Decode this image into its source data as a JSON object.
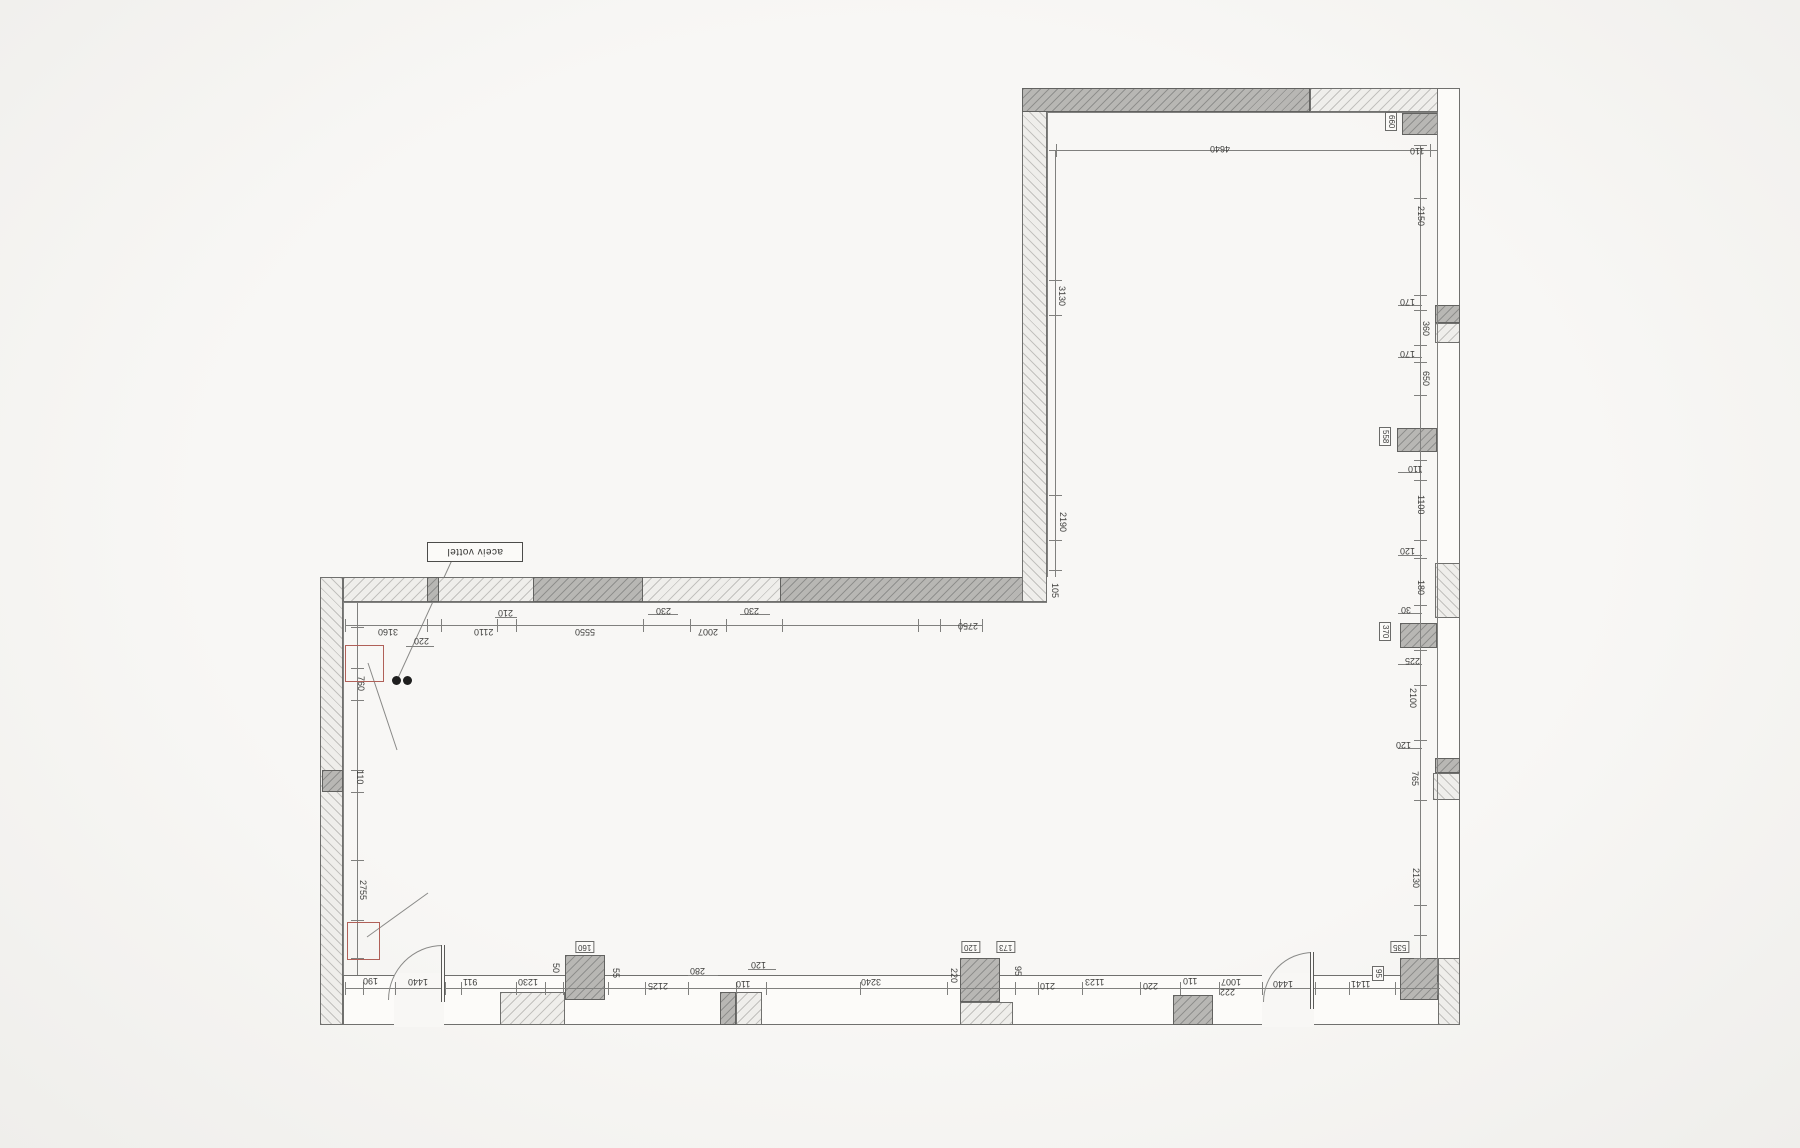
{
  "plan": {
    "label_box": {
      "text": "aceiv vottel"
    },
    "colors": {
      "wall_outline": "#70706e",
      "dark_fill": "#b8b7b4",
      "hatch_fill": "#efeeeb",
      "dimension_text": "#3d3d3b",
      "marker_red": "#b06058",
      "dot_black": "#1f1f1f"
    },
    "walls": [
      {
        "name": "left-wall",
        "x": 320,
        "y": 577,
        "w": 23,
        "h": 448,
        "style": "hatch-v"
      },
      {
        "name": "left-wall-pier",
        "x": 322,
        "y": 770,
        "w": 21,
        "h": 22,
        "style": "dark"
      },
      {
        "name": "lower-top-wall",
        "x": 343,
        "y": 577,
        "w": 704,
        "h": 25,
        "style": "hatch-h"
      },
      {
        "name": "lower-top-wall-pier",
        "x": 427,
        "y": 577,
        "w": 12,
        "h": 25,
        "style": "dark"
      },
      {
        "name": "lower-top-window-a",
        "x": 533,
        "y": 577,
        "w": 110,
        "h": 25,
        "style": "dark"
      },
      {
        "name": "lower-top-window-b",
        "x": 780,
        "y": 577,
        "w": 260,
        "h": 25,
        "style": "dark"
      },
      {
        "name": "upper-left-wall",
        "x": 1022,
        "y": 88,
        "w": 25,
        "h": 514,
        "style": "hatch-v"
      },
      {
        "name": "upper-top-wall-dark",
        "x": 1022,
        "y": 88,
        "w": 288,
        "h": 24,
        "style": "dark"
      },
      {
        "name": "upper-top-wall-light",
        "x": 1310,
        "y": 88,
        "w": 150,
        "h": 24,
        "style": "hatch-h"
      },
      {
        "name": "right-wall",
        "x": 1437,
        "y": 88,
        "w": 23,
        "h": 937,
        "style": "plain"
      },
      {
        "name": "right-pier-1",
        "x": 1402,
        "y": 113,
        "w": 36,
        "h": 22,
        "style": "dark"
      },
      {
        "name": "right-pier-2a",
        "x": 1435,
        "y": 305,
        "w": 25,
        "h": 18,
        "style": "dark"
      },
      {
        "name": "right-pier-2b",
        "x": 1435,
        "y": 323,
        "w": 25,
        "h": 20,
        "style": "hatch-h"
      },
      {
        "name": "right-pier-3",
        "x": 1397,
        "y": 428,
        "w": 40,
        "h": 24,
        "style": "dark"
      },
      {
        "name": "right-pilaster",
        "x": 1435,
        "y": 563,
        "w": 25,
        "h": 55,
        "style": "hatch-v"
      },
      {
        "name": "right-pier-4",
        "x": 1400,
        "y": 623,
        "w": 37,
        "h": 25,
        "style": "dark"
      },
      {
        "name": "right-pier-5a",
        "x": 1435,
        "y": 758,
        "w": 25,
        "h": 15,
        "style": "dark"
      },
      {
        "name": "right-pier-5b",
        "x": 1433,
        "y": 773,
        "w": 27,
        "h": 27,
        "style": "hatch-v"
      },
      {
        "name": "bottom-wall",
        "x": 343,
        "y": 975,
        "w": 1117,
        "h": 50,
        "style": "plain"
      },
      {
        "name": "bottom-hatch-1",
        "x": 500,
        "y": 992,
        "w": 65,
        "h": 33,
        "style": "hatch-h"
      },
      {
        "name": "bottom-pier-1",
        "x": 565,
        "y": 955,
        "w": 40,
        "h": 45,
        "style": "dark"
      },
      {
        "name": "bottom-pier-2",
        "x": 720,
        "y": 992,
        "w": 16,
        "h": 33,
        "style": "dark"
      },
      {
        "name": "bottom-hatch-2",
        "x": 736,
        "y": 992,
        "w": 26,
        "h": 33,
        "style": "hatch-h"
      },
      {
        "name": "bottom-pier-3",
        "x": 960,
        "y": 958,
        "w": 40,
        "h": 44,
        "style": "dark"
      },
      {
        "name": "bottom-hatch-3",
        "x": 960,
        "y": 1002,
        "w": 53,
        "h": 23,
        "style": "hatch-h"
      },
      {
        "name": "bottom-pier-4",
        "x": 1173,
        "y": 995,
        "w": 40,
        "h": 30,
        "style": "dark"
      },
      {
        "name": "bottom-right-pier",
        "x": 1400,
        "y": 958,
        "w": 38,
        "h": 42,
        "style": "dark"
      },
      {
        "name": "bottom-right-corner",
        "x": 1438,
        "y": 958,
        "w": 22,
        "h": 67,
        "style": "hatch-v"
      }
    ],
    "door_gaps": [
      {
        "x": 394,
        "y": 973,
        "w": 50,
        "h": 54
      },
      {
        "x": 1262,
        "y": 973,
        "w": 52,
        "h": 54
      }
    ],
    "doors": [
      {
        "arc": {
          "x": 388,
          "y": 945,
          "w": 55,
          "h": 55
        },
        "leaf": {
          "x": 441,
          "y": 945,
          "w": 4,
          "h": 57
        }
      },
      {
        "arc": {
          "x": 1263,
          "y": 952,
          "w": 50,
          "h": 50
        },
        "leaf": {
          "x": 1310,
          "y": 952,
          "w": 4,
          "h": 57
        }
      }
    ],
    "lines": [
      {
        "x": 343,
        "y": 602,
        "w": 704,
        "h": 1
      },
      {
        "x": 343,
        "y": 602,
        "w": 1,
        "h": 373
      },
      {
        "x": 1047,
        "y": 112,
        "w": 390,
        "h": 1
      },
      {
        "x": 1047,
        "y": 112,
        "w": 1,
        "h": 465
      },
      {
        "x": 1437,
        "y": 112,
        "w": 1,
        "h": 863
      },
      {
        "x": 345,
        "y": 625,
        "w": 637,
        "h": 1
      },
      {
        "x": 357,
        "y": 602,
        "w": 1,
        "h": 373
      },
      {
        "x": 1055,
        "y": 150,
        "w": 382,
        "h": 1
      },
      {
        "x": 1055,
        "y": 150,
        "w": 1,
        "h": 427
      },
      {
        "x": 1420,
        "y": 145,
        "w": 1,
        "h": 815
      },
      {
        "x": 345,
        "y": 988,
        "w": 1095,
        "h": 1
      },
      {
        "x": 495,
        "y": 617,
        "w": 22,
        "h": 1
      },
      {
        "x": 648,
        "y": 614,
        "w": 30,
        "h": 1
      },
      {
        "x": 740,
        "y": 614,
        "w": 30,
        "h": 1
      },
      {
        "x": 406,
        "y": 646,
        "w": 28,
        "h": 1
      },
      {
        "x": 748,
        "y": 969,
        "w": 28,
        "h": 1
      },
      {
        "x": 688,
        "y": 975,
        "w": 30,
        "h": 1
      },
      {
        "x": 1398,
        "y": 305,
        "w": 24,
        "h": 1
      },
      {
        "x": 1398,
        "y": 357,
        "w": 24,
        "h": 1
      },
      {
        "x": 1398,
        "y": 472,
        "w": 24,
        "h": 1
      },
      {
        "x": 1398,
        "y": 555,
        "w": 24,
        "h": 1
      },
      {
        "x": 1398,
        "y": 613,
        "w": 24,
        "h": 1
      },
      {
        "x": 1398,
        "y": 664,
        "w": 24,
        "h": 1
      },
      {
        "x": 1398,
        "y": 748,
        "w": 24,
        "h": 1
      }
    ],
    "ticks": [
      {
        "dir": "v",
        "y": 619,
        "h": 13,
        "xs": [
          345,
          427,
          441,
          497,
          516,
          643,
          690,
          726,
          782,
          918,
          940,
          960,
          982
        ]
      },
      {
        "dir": "v",
        "y": 982,
        "h": 13,
        "xs": [
          345,
          363,
          395,
          445,
          461,
          516,
          545,
          563,
          608,
          645,
          688,
          736,
          766,
          860,
          947,
          1015,
          1038,
          1082,
          1140,
          1180,
          1219,
          1262,
          1315,
          1349,
          1395,
          1437
        ]
      },
      {
        "dir": "h",
        "x": 1414,
        "w": 13,
        "ys": [
          145,
          198,
          295,
          310,
          345,
          362,
          395,
          460,
          480,
          540,
          558,
          605,
          650,
          685,
          740,
          800,
          905,
          935,
          958
        ]
      },
      {
        "dir": "h",
        "x": 351,
        "w": 13,
        "ys": [
          627,
          668,
          700,
          770,
          792,
          860,
          920,
          958
        ]
      },
      {
        "dir": "h",
        "x": 1049,
        "w": 13,
        "ys": [
          150,
          280,
          315,
          495,
          540,
          570
        ]
      },
      {
        "dir": "v",
        "y": 144,
        "h": 13,
        "xs": [
          1056,
          1430
        ]
      }
    ],
    "dim_chains": {
      "top": [
        {
          "t": "3160",
          "x": 378,
          "y": 627
        },
        {
          "t": "220",
          "x": 414,
          "y": 636
        },
        {
          "t": "2110",
          "x": 474,
          "y": 627
        },
        {
          "t": "210",
          "x": 498,
          "y": 608
        },
        {
          "t": "5550",
          "x": 575,
          "y": 627
        },
        {
          "t": "230",
          "x": 656,
          "y": 606
        },
        {
          "t": "2007",
          "x": 698,
          "y": 627
        },
        {
          "t": "230",
          "x": 744,
          "y": 606
        },
        {
          "t": "2750",
          "x": 958,
          "y": 621
        },
        {
          "t": "105",
          "x": 1050,
          "y": 583,
          "vert": true
        }
      ],
      "upper": [
        {
          "t": "4640",
          "x": 1210,
          "y": 144
        },
        {
          "t": "3130",
          "x": 1057,
          "y": 286,
          "vert": true
        },
        {
          "t": "2190",
          "x": 1058,
          "y": 512,
          "vert": true
        }
      ],
      "left": [
        {
          "t": "760",
          "x": 356,
          "y": 676,
          "vert": true
        },
        {
          "t": "110",
          "x": 355,
          "y": 770,
          "vert": true
        },
        {
          "t": "2755",
          "x": 358,
          "y": 880,
          "vert": true
        }
      ],
      "right": [
        {
          "t": "660",
          "x": 1387,
          "y": 112,
          "vert": true,
          "boxed": true
        },
        {
          "t": "110",
          "x": 1410,
          "y": 146
        },
        {
          "t": "2150",
          "x": 1416,
          "y": 206,
          "vert": true
        },
        {
          "t": "170",
          "x": 1400,
          "y": 297
        },
        {
          "t": "360",
          "x": 1421,
          "y": 321,
          "vert": true
        },
        {
          "t": "170",
          "x": 1400,
          "y": 349
        },
        {
          "t": "650",
          "x": 1421,
          "y": 371,
          "vert": true
        },
        {
          "t": "558",
          "x": 1381,
          "y": 427,
          "vert": true,
          "boxed": true
        },
        {
          "t": "110",
          "x": 1408,
          "y": 464
        },
        {
          "t": "1100",
          "x": 1416,
          "y": 495,
          "vert": true
        },
        {
          "t": "120",
          "x": 1400,
          "y": 546
        },
        {
          "t": "180",
          "x": 1416,
          "y": 580,
          "vert": true
        },
        {
          "t": "30",
          "x": 1401,
          "y": 605
        },
        {
          "t": "370",
          "x": 1381,
          "y": 622,
          "vert": true,
          "boxed": true
        },
        {
          "t": "225",
          "x": 1405,
          "y": 656
        },
        {
          "t": "2100",
          "x": 1408,
          "y": 688,
          "vert": true
        },
        {
          "t": "120",
          "x": 1396,
          "y": 740
        },
        {
          "t": "765",
          "x": 1410,
          "y": 771,
          "vert": true
        },
        {
          "t": "2130",
          "x": 1411,
          "y": 868,
          "vert": true
        },
        {
          "t": "535",
          "x": 1390,
          "y": 941,
          "boxed": true
        },
        {
          "t": "95",
          "x": 1374,
          "y": 966,
          "vert": true,
          "boxed": true
        }
      ],
      "bottom": [
        {
          "t": "190",
          "x": 363,
          "y": 976
        },
        {
          "t": "1440",
          "x": 408,
          "y": 977
        },
        {
          "t": "911",
          "x": 463,
          "y": 977
        },
        {
          "t": "1230",
          "x": 518,
          "y": 977
        },
        {
          "t": "50",
          "x": 551,
          "y": 963,
          "vert": true
        },
        {
          "t": "160",
          "x": 575,
          "y": 941,
          "boxed": true
        },
        {
          "t": "55",
          "x": 611,
          "y": 968,
          "vert": true
        },
        {
          "t": "2125",
          "x": 648,
          "y": 981
        },
        {
          "t": "280",
          "x": 690,
          "y": 966
        },
        {
          "t": "110",
          "x": 736,
          "y": 979
        },
        {
          "t": "120",
          "x": 751,
          "y": 960
        },
        {
          "t": "3240",
          "x": 861,
          "y": 977
        },
        {
          "t": "220",
          "x": 949,
          "y": 968,
          "vert": true
        },
        {
          "t": "120",
          "x": 961,
          "y": 941,
          "boxed": true
        },
        {
          "t": "173",
          "x": 996,
          "y": 941,
          "boxed": true
        },
        {
          "t": "95",
          "x": 1013,
          "y": 966,
          "vert": true
        },
        {
          "t": "210",
          "x": 1040,
          "y": 981
        },
        {
          "t": "1123",
          "x": 1085,
          "y": 977
        },
        {
          "t": "220",
          "x": 1143,
          "y": 981
        },
        {
          "t": "110",
          "x": 1183,
          "y": 976
        },
        {
          "t": "1007",
          "x": 1221,
          "y": 977
        },
        {
          "t": "222",
          "x": 1220,
          "y": 987
        },
        {
          "t": "1440",
          "x": 1273,
          "y": 979
        },
        {
          "t": "1141",
          "x": 1351,
          "y": 979
        }
      ]
    },
    "markers": [
      {
        "x": 345,
        "y": 645,
        "w": 37,
        "h": 35
      },
      {
        "x": 347,
        "y": 922,
        "w": 31,
        "h": 36
      }
    ],
    "outlet_dots": [
      {
        "x": 392,
        "y": 676
      },
      {
        "x": 403,
        "y": 676
      }
    ],
    "leaders": [
      {
        "name": "label-leader",
        "x1": 452,
        "y1": 560,
        "x2": 398,
        "y2": 678
      },
      {
        "name": "marker-leader-1",
        "x1": 368,
        "y1": 663,
        "x2": 397,
        "y2": 750
      },
      {
        "name": "marker-leader-2",
        "x1": 367,
        "y1": 937,
        "x2": 428,
        "y2": 893
      }
    ]
  }
}
